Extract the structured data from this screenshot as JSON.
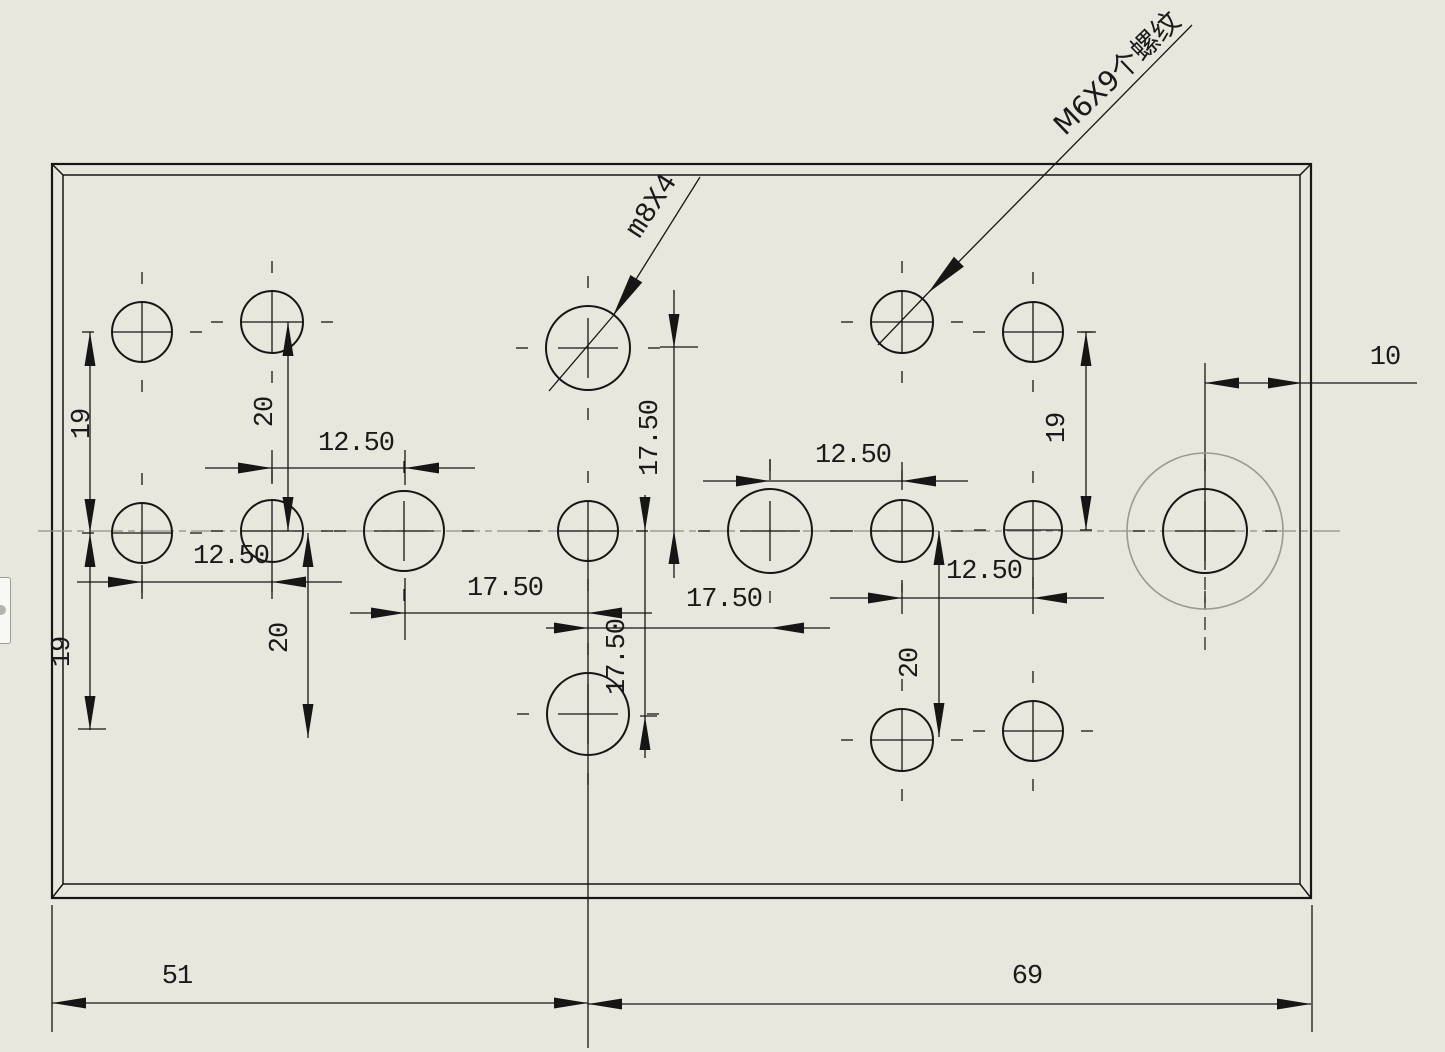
{
  "drawing": {
    "title": "plate-hole-drawing",
    "background": "#e8e7dd",
    "line_color": "#161616",
    "centerline_color": "#8f8f88",
    "canvas": {
      "width": 1445,
      "height": 1052
    }
  },
  "plate": {
    "outer": {
      "x1": 52,
      "y1": 164,
      "x2": 1311,
      "y2": 898
    },
    "inner": {
      "x1": 63,
      "y1": 175,
      "x2": 1300,
      "y2": 884
    }
  },
  "centerline": {
    "y": 531,
    "x1": 38,
    "x2": 1340
  },
  "holes": [
    {
      "cx": 142,
      "cy": 332,
      "r": 30
    },
    {
      "cx": 272,
      "cy": 322,
      "r": 31
    },
    {
      "cx": 142,
      "cy": 533,
      "r": 30
    },
    {
      "cx": 272,
      "cy": 531,
      "r": 31
    },
    {
      "cx": 404,
      "cy": 531,
      "r": 40
    },
    {
      "cx": 588,
      "cy": 348,
      "r": 42
    },
    {
      "cx": 588,
      "cy": 531,
      "r": 30
    },
    {
      "cx": 588,
      "cy": 714,
      "r": 41
    },
    {
      "cx": 770,
      "cy": 531,
      "r": 42
    },
    {
      "cx": 902,
      "cy": 322,
      "r": 31
    },
    {
      "cx": 1033,
      "cy": 332,
      "r": 30
    },
    {
      "cx": 902,
      "cy": 531,
      "r": 31
    },
    {
      "cx": 1033,
      "cy": 530,
      "r": 29
    },
    {
      "cx": 902,
      "cy": 740,
      "r": 31
    },
    {
      "cx": 1033,
      "cy": 731,
      "r": 30
    },
    {
      "cx": 1205,
      "cy": 531,
      "r": 42,
      "outer_r": 78
    }
  ],
  "dimensions": [
    {
      "value": "19",
      "text": {
        "x": 83,
        "y": 424,
        "rot": -90
      },
      "line": [
        90,
        332,
        90,
        533
      ],
      "arrows": [
        [
          90,
          332,
          "up"
        ],
        [
          90,
          533,
          "down"
        ]
      ]
    },
    {
      "value": "20",
      "text": {
        "x": 266,
        "y": 412,
        "rot": -90
      },
      "line": [
        288,
        322,
        288,
        531
      ],
      "arrows": [
        [
          288,
          322,
          "up"
        ],
        [
          288,
          531,
          "down"
        ]
      ]
    },
    {
      "value": "12.50",
      "text": {
        "x": 356,
        "y": 444,
        "rot": 0
      },
      "line": [
        205,
        468,
        475,
        468
      ],
      "arrows": [
        [
          272,
          468,
          "right"
        ],
        [
          405,
          468,
          "left"
        ]
      ]
    },
    {
      "value": "12.50",
      "text": {
        "x": 231,
        "y": 557,
        "rot": 0
      },
      "line": [
        77,
        582,
        342,
        582
      ],
      "arrows": [
        [
          142,
          582,
          "right"
        ],
        [
          272,
          582,
          "left"
        ]
      ]
    },
    {
      "value": "19",
      "text": {
        "x": 63,
        "y": 652,
        "rot": -90
      },
      "line": [
        90,
        533,
        90,
        730
      ],
      "arrows": [
        [
          90,
          533,
          "up"
        ],
        [
          90,
          730,
          "down"
        ]
      ]
    },
    {
      "value": "20",
      "text": {
        "x": 281,
        "y": 638,
        "rot": -90
      },
      "line": [
        308,
        533,
        308,
        738
      ],
      "arrows": [
        [
          308,
          533,
          "up"
        ],
        [
          308,
          738,
          "down"
        ]
      ]
    },
    {
      "value": "17.50",
      "text": {
        "x": 505,
        "y": 589,
        "rot": 0
      },
      "line": [
        350,
        613,
        652,
        613
      ],
      "arrows": [
        [
          405,
          613,
          "right"
        ],
        [
          588,
          613,
          "left"
        ]
      ]
    },
    {
      "value": "17.50",
      "text": {
        "x": 724,
        "y": 600,
        "rot": 0
      },
      "line": [
        546,
        628,
        830,
        628
      ],
      "arrows": [
        [
          588,
          628,
          "right"
        ],
        [
          770,
          628,
          "left"
        ]
      ]
    },
    {
      "value": "17.50",
      "text": {
        "x": 651,
        "y": 438,
        "rot": -90
      },
      "line": [
        674,
        290,
        674,
        578
      ],
      "arrows": [
        [
          674,
          348,
          "down"
        ],
        [
          674,
          530,
          "up"
        ]
      ]
    },
    {
      "value": "17.50",
      "text": {
        "x": 618,
        "y": 657,
        "rot": -90
      },
      "line": [
        645,
        495,
        645,
        758
      ],
      "arrows": [
        [
          645,
          531,
          "down"
        ],
        [
          645,
          716,
          "up"
        ]
      ]
    },
    {
      "value": "12.50",
      "text": {
        "x": 853,
        "y": 456,
        "rot": 0
      },
      "line": [
        703,
        481,
        968,
        481
      ],
      "arrows": [
        [
          770,
          481,
          "right"
        ],
        [
          902,
          481,
          "left"
        ]
      ]
    },
    {
      "value": "12.50",
      "text": {
        "x": 984,
        "y": 572,
        "rot": 0
      },
      "line": [
        830,
        598,
        1104,
        598
      ],
      "arrows": [
        [
          902,
          598,
          "right"
        ],
        [
          1033,
          598,
          "left"
        ]
      ]
    },
    {
      "value": "19",
      "text": {
        "x": 1058,
        "y": 428,
        "rot": -90
      },
      "line": [
        1086,
        332,
        1086,
        530
      ],
      "arrows": [
        [
          1086,
          332,
          "up"
        ],
        [
          1086,
          530,
          "down"
        ]
      ]
    },
    {
      "value": "20",
      "text": {
        "x": 911,
        "y": 663,
        "rot": -90
      },
      "line": [
        939,
        531,
        939,
        737
      ],
      "arrows": [
        [
          939,
          531,
          "up"
        ],
        [
          939,
          737,
          "down"
        ]
      ]
    },
    {
      "value": "10",
      "text": {
        "x": 1385,
        "y": 358,
        "rot": 0
      },
      "line": [
        1205,
        383,
        1417,
        383
      ],
      "arrows": [
        [
          1205,
          383,
          "left"
        ],
        [
          1302,
          383,
          "right"
        ]
      ]
    },
    {
      "value": "51",
      "text": {
        "x": 177,
        "y": 977,
        "rot": 0
      },
      "line": [
        52,
        1003,
        588,
        1003
      ],
      "arrows": [
        [
          52,
          1003,
          "left"
        ],
        [
          588,
          1003,
          "right"
        ]
      ]
    },
    {
      "value": "69",
      "text": {
        "x": 1027,
        "y": 977,
        "rot": 0
      },
      "line": [
        588,
        1004,
        1311,
        1004
      ],
      "arrows": [
        [
          588,
          1004,
          "left"
        ],
        [
          1311,
          1004,
          "right"
        ]
      ]
    }
  ],
  "ticks": [
    [
      142,
      565,
      142,
      599
    ],
    [
      272,
      560,
      272,
      599
    ],
    [
      272,
      450,
      272,
      484
    ],
    [
      405,
      450,
      405,
      485
    ],
    [
      405,
      578,
      405,
      640
    ],
    [
      770,
      460,
      770,
      480
    ],
    [
      902,
      462,
      902,
      490
    ],
    [
      902,
      583,
      902,
      614
    ],
    [
      1033,
      560,
      1033,
      614
    ],
    [
      660,
      347,
      698,
      347
    ],
    [
      1077,
      332,
      1096,
      332
    ],
    [
      78,
      729,
      106,
      729
    ],
    [
      640,
      716,
      657,
      716
    ]
  ],
  "ext_lines": [
    [
      52,
      905,
      52,
      1032
    ],
    [
      1312,
      905,
      1312,
      1032
    ],
    [
      588,
      558,
      588,
      1048
    ],
    [
      1205,
      363,
      1205,
      570
    ]
  ],
  "dashed_ext_lines": [
    [
      1205,
      577,
      1205,
      656
    ]
  ],
  "leaders": [
    {
      "text": "m8X4",
      "cjk": false,
      "text_pos": {
        "x": 652,
        "y": 206,
        "rot": -57
      },
      "line": [
        700,
        177,
        613,
        316
      ],
      "tail": [
        613,
        316,
        549,
        391
      ]
    },
    {
      "text": "M6X9个螺纹",
      "cjk": true,
      "text_pos": {
        "x": 1117,
        "y": 73,
        "rot": -44
      },
      "line": [
        1192,
        25,
        928,
        293
      ],
      "tail": [
        928,
        293,
        878,
        345
      ]
    }
  ],
  "side_panel_tab": {
    "tooltip": "collapsed-panel-tab"
  }
}
